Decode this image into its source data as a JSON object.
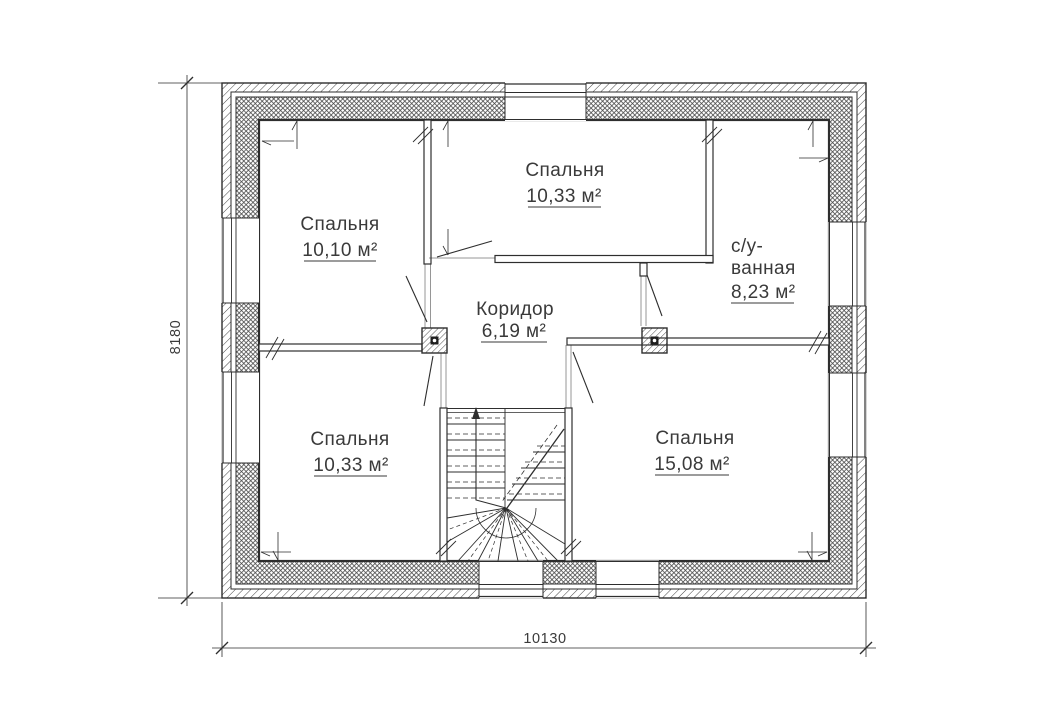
{
  "plan": {
    "rooms": [
      {
        "name": "Спальня",
        "area": "10,10 м²"
      },
      {
        "name": "Спальня",
        "area": "10,33 м²"
      },
      {
        "name_line1": "с/у-",
        "name_line2": "ванная",
        "area": "8,23 м²"
      },
      {
        "name": "Коридор",
        "area": "6,19 м²"
      },
      {
        "name": "Спальня",
        "area": "10,33 м²"
      },
      {
        "name": "Спальня",
        "area": "15,08 м²"
      }
    ],
    "dimensions": {
      "overall_width": "10130",
      "overall_height": "8180"
    },
    "colors": {
      "line": "#2e2e2e",
      "hatch": "#454545",
      "text": "#3a3a3a",
      "background": "#ffffff"
    }
  }
}
